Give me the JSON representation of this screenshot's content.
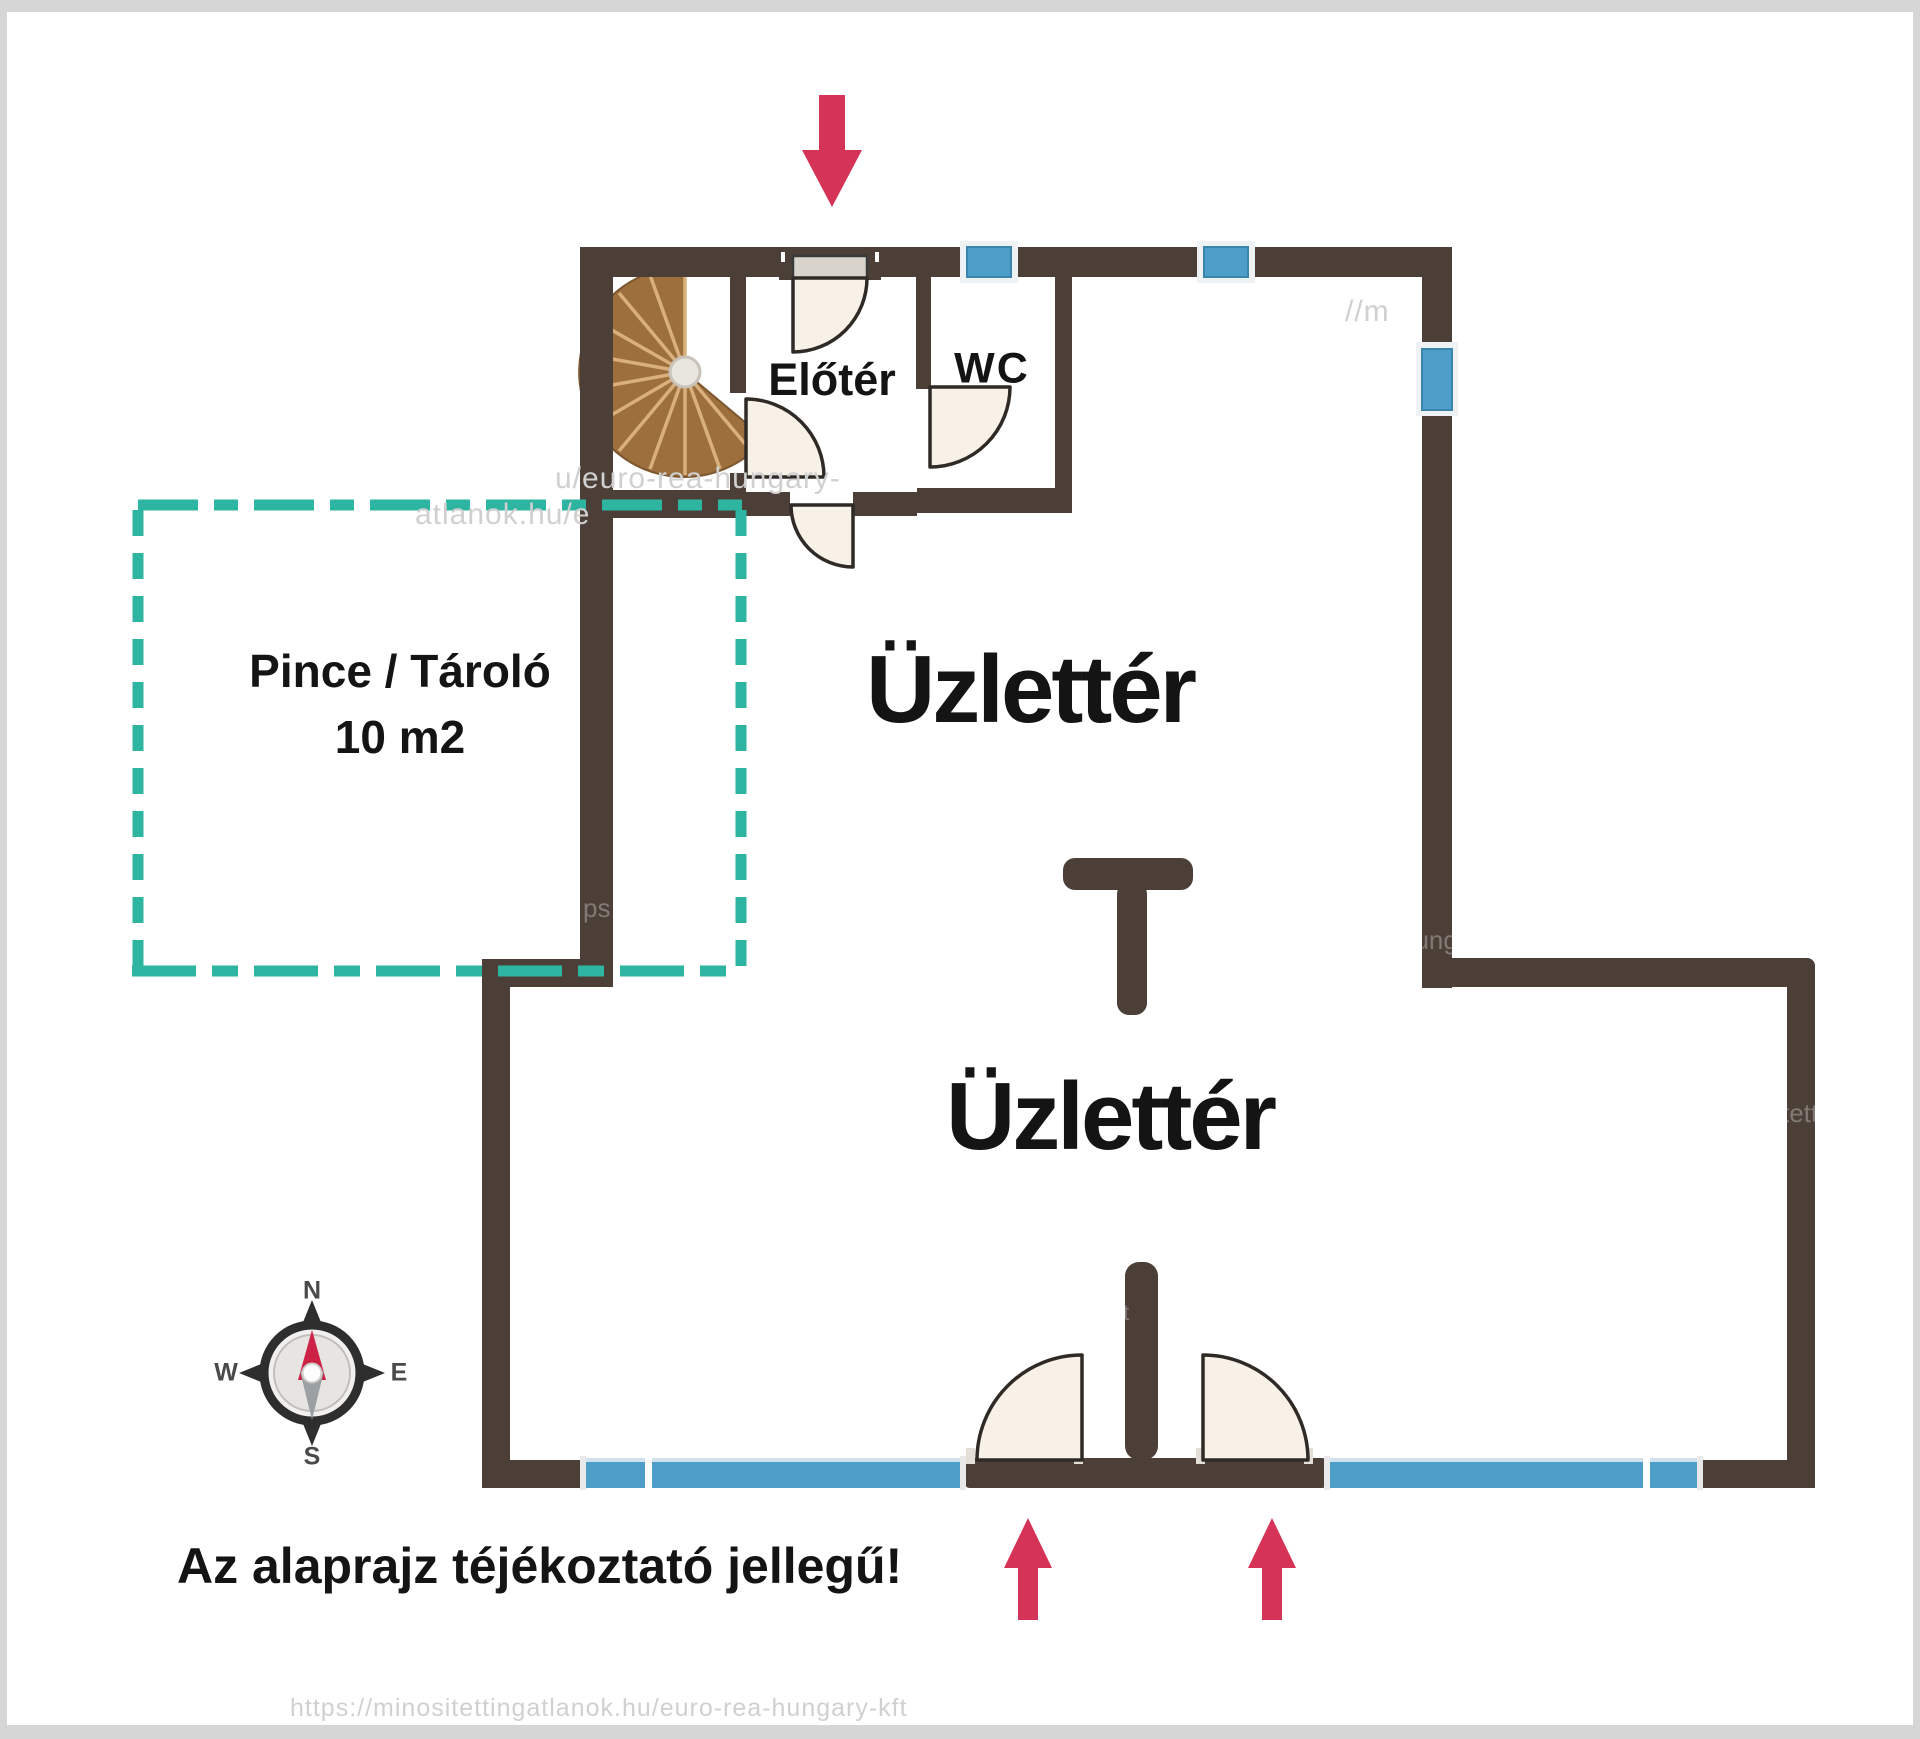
{
  "document": {
    "type": "real-estate floor plan",
    "language": "Hungarian"
  },
  "labels": {
    "shop_upper": "Üzlettér",
    "shop_lower": "Üzlettér",
    "foyer": "Előtér",
    "wc": "WC",
    "cellar_line1": "Pince / Tároló",
    "cellar_line2": "10 m2",
    "disclaimer": "Az alaprajz téjékoztató jellegű!"
  },
  "compass": {
    "n": "N",
    "e": "E",
    "s": "S",
    "w": "W"
  },
  "watermarks": {
    "w1": "u/euro-rea-hungary-",
    "w2": "//m",
    "w3": "atlanok.hu/e",
    "w4": "ps:/",
    "w5": "hung",
    "w6": "tett",
    "w7": "https://minositettingatlanok.hu/euro-rea-hungary-kft",
    "w8": "kft"
  },
  "icons": {
    "entrance_arrow_top": "red-arrow-down",
    "entrance_arrow_bottom_left": "red-arrow-up",
    "entrance_arrow_bottom_right": "red-arrow-up",
    "compass_rose": "compass-rose",
    "spiral_staircase": "spiral-staircase"
  },
  "colors": {
    "wall": "#4b3f37",
    "glazing": "#4d9fca",
    "glazing_light": "#cfe2ee",
    "teal": "#2db5a2",
    "door_fill": "#f7f1e7",
    "door_stroke": "#2f2a26",
    "stair_fill": "#9c6f3d",
    "stair_spoke": "#d9b07c",
    "arrow": "#d63358",
    "text": "#141414",
    "watermark_grey": "#d0d0d0",
    "frame_grey": "#d6d6d6",
    "compass_dark": "#2e2e2e",
    "needle_red": "#cc2246",
    "needle_grey": "#9aa0a4"
  }
}
